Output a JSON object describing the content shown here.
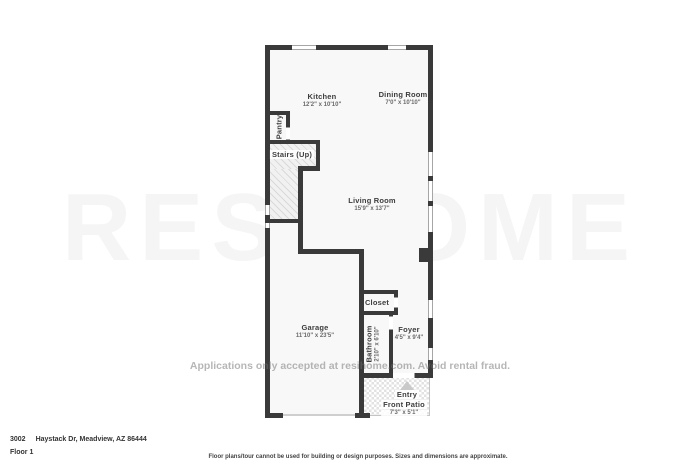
{
  "watermark": {
    "large_text": "RESIHOME",
    "line_text": "Applications only accepted at resihome.com. Avoid rental fraud."
  },
  "rooms": {
    "kitchen": {
      "name": "Kitchen",
      "dims": "12'2\" x 10'10\""
    },
    "dining": {
      "name": "Dining Room",
      "dims": "7'0\" x 10'10\""
    },
    "pantry": {
      "name": "Pantry"
    },
    "stairs": {
      "name": "Stairs (Up)"
    },
    "living": {
      "name": "Living Room",
      "dims": "15'9\" x 13'7\""
    },
    "closet": {
      "name": "Closet"
    },
    "garage": {
      "name": "Garage",
      "dims": "11'10\" x 23'5\""
    },
    "bathroom": {
      "name": "Bathroom",
      "dims": "2'10\" x 6'10\""
    },
    "foyer": {
      "name": "Foyer",
      "dims": "4'5\" x 9'4\""
    },
    "entry": {
      "name": "Entry"
    },
    "front_patio": {
      "name": "Front Patio",
      "dims": "7'3\" x 5'1\""
    }
  },
  "footer": {
    "unit_number": "3002",
    "address": "Haystack Dr, Meadview, AZ 86444",
    "floor_label": "Floor 1",
    "disclaimer": "Floor plans/tour cannot be used for building or design purposes. Sizes and dimensions are approximate."
  },
  "colors": {
    "wall": "#3a3a3a",
    "room_fill": "#f8f8f8",
    "patio_checker": "#e2e2e2",
    "watermark": "#8f8f8f"
  }
}
